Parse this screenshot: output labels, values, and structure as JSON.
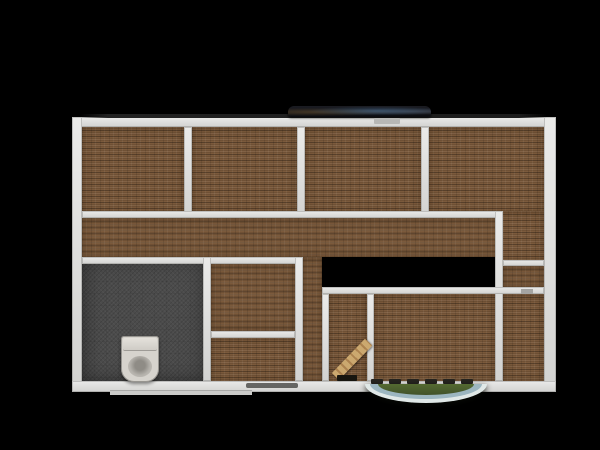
{
  "scene": {
    "description": "top-down 3d render of a house floor plan on black background",
    "canvas": {
      "width": 600,
      "height": 450
    },
    "background_color": "#000000"
  },
  "palette": {
    "floor_wood": "#7b5a3c",
    "floor_wood_seam": "#64482c",
    "wall": "#dfdfdd",
    "wall_edge": "#737370",
    "bathroom_floor": "#4b4b4b",
    "toilet": "#d6d3cd",
    "stair_wood": "#c8a26c",
    "porch_green": "#4a5d2e",
    "porch_blue": "#9cb6c0",
    "porch_white": "#e0e8e7",
    "balcony_dark": "#14151b"
  },
  "floorplan": {
    "outer_bounds": {
      "x": 72,
      "y": 117,
      "w": 484,
      "h": 275
    },
    "floors": [
      {
        "id": "room-top-left",
        "type": "wood",
        "x": 82,
        "y": 127,
        "w": 102,
        "h": 88
      },
      {
        "id": "room-top-mid-left",
        "type": "wood",
        "x": 192,
        "y": 127,
        "w": 105,
        "h": 88
      },
      {
        "id": "room-top-mid-right",
        "type": "wood",
        "x": 305,
        "y": 127,
        "w": 116,
        "h": 88
      },
      {
        "id": "room-top-right",
        "type": "wood",
        "x": 429,
        "y": 127,
        "w": 115,
        "h": 88
      },
      {
        "id": "room-top-right-ext",
        "type": "wood",
        "x": 499,
        "y": 211,
        "w": 45,
        "h": 52
      },
      {
        "id": "hallway",
        "type": "wood",
        "x": 82,
        "y": 218,
        "w": 417,
        "h": 39
      },
      {
        "id": "bathroom",
        "type": "tile",
        "x": 82,
        "y": 257,
        "w": 125,
        "h": 125
      },
      {
        "id": "storage-room-upper",
        "type": "wood",
        "x": 211,
        "y": 264,
        "w": 84,
        "h": 67
      },
      {
        "id": "storage-room-lower",
        "type": "wood",
        "x": 211,
        "y": 338,
        "w": 84,
        "h": 44
      },
      {
        "id": "hall-passage",
        "type": "wood",
        "x": 303,
        "y": 257,
        "w": 19,
        "h": 125
      },
      {
        "id": "stair-room",
        "type": "wood",
        "x": 329,
        "y": 294,
        "w": 38,
        "h": 88
      },
      {
        "id": "room-bottom-mid",
        "type": "wood",
        "x": 374,
        "y": 294,
        "w": 121,
        "h": 88
      },
      {
        "id": "room-right-strip",
        "type": "wood",
        "x": 503,
        "y": 266,
        "w": 41,
        "h": 21
      },
      {
        "id": "room-bottom-right",
        "type": "wood",
        "x": 503,
        "y": 294,
        "w": 41,
        "h": 88
      }
    ],
    "walls": [
      {
        "id": "wall-outer-top",
        "x": 72,
        "y": 117,
        "w": 484,
        "h": 10
      },
      {
        "id": "wall-outer-left",
        "x": 72,
        "y": 117,
        "w": 10,
        "h": 275
      },
      {
        "id": "wall-outer-right",
        "x": 544,
        "y": 117,
        "w": 12,
        "h": 275
      },
      {
        "id": "wall-outer-bottom",
        "x": 72,
        "y": 381,
        "w": 484,
        "h": 11
      },
      {
        "id": "wall-top-rooms-1-2",
        "x": 184,
        "y": 127,
        "w": 8,
        "h": 91
      },
      {
        "id": "wall-top-rooms-2-3",
        "x": 297,
        "y": 127,
        "w": 8,
        "h": 91
      },
      {
        "id": "wall-top-rooms-3-4",
        "x": 421,
        "y": 127,
        "w": 8,
        "h": 91
      },
      {
        "id": "wall-hallway-top",
        "x": 82,
        "y": 211,
        "w": 417,
        "h": 7
      },
      {
        "id": "wall-right-vertical",
        "x": 495,
        "y": 211,
        "w": 8,
        "h": 170
      },
      {
        "id": "wall-hallway-bottom",
        "x": 82,
        "y": 257,
        "w": 221,
        "h": 7
      },
      {
        "id": "wall-right-upper",
        "x": 503,
        "y": 260,
        "w": 41,
        "h": 6
      },
      {
        "id": "wall-mid-horizontal",
        "x": 322,
        "y": 287,
        "w": 222,
        "h": 7
      },
      {
        "id": "wall-bathroom-right",
        "x": 203,
        "y": 257,
        "w": 8,
        "h": 124
      },
      {
        "id": "wall-storage-right",
        "x": 295,
        "y": 257,
        "w": 8,
        "h": 124
      },
      {
        "id": "wall-storage-divider",
        "x": 211,
        "y": 331,
        "w": 84,
        "h": 7
      },
      {
        "id": "wall-stair-room-left",
        "x": 322,
        "y": 294,
        "w": 7,
        "h": 87
      },
      {
        "id": "wall-stair-room-right",
        "x": 367,
        "y": 294,
        "w": 7,
        "h": 87
      }
    ],
    "objects": [
      {
        "id": "exterior-top-shade",
        "type": "topshade",
        "x": 80,
        "y": 114,
        "w": 467,
        "h": 4,
        "interactable": false
      },
      {
        "id": "balcony-terrace",
        "type": "balcony",
        "x": 288,
        "y": 106,
        "w": 143,
        "h": 11,
        "interactable": true
      },
      {
        "id": "balcony-door-mark",
        "type": "doormark",
        "x": 374,
        "y": 118,
        "w": 26,
        "h": 6,
        "interactable": false
      },
      {
        "id": "bottom-window-sill",
        "type": "sill",
        "x": 110,
        "y": 390,
        "w": 142,
        "h": 5,
        "interactable": false
      },
      {
        "id": "toilet",
        "type": "toilet",
        "x": 121,
        "y": 336,
        "w": 38,
        "h": 46,
        "interactable": true
      },
      {
        "id": "stair-flight",
        "type": "stair",
        "x": 339,
        "y": 370,
        "w": 48,
        "h": 10,
        "interactable": true
      },
      {
        "id": "stair-threshold",
        "type": "threshold",
        "x": 337,
        "y": 375,
        "w": 20,
        "h": 6,
        "interactable": false
      },
      {
        "id": "entry-door-dash-1",
        "type": "dash",
        "x": 371,
        "y": 379,
        "w": 12,
        "h": 5,
        "interactable": false
      },
      {
        "id": "entry-door-dash-2",
        "type": "dash",
        "x": 389,
        "y": 379,
        "w": 12,
        "h": 5,
        "interactable": false
      },
      {
        "id": "entry-door-dash-3",
        "type": "dash",
        "x": 407,
        "y": 379,
        "w": 12,
        "h": 5,
        "interactable": false
      },
      {
        "id": "entry-door-dash-4",
        "type": "dash",
        "x": 425,
        "y": 379,
        "w": 12,
        "h": 5,
        "interactable": false
      },
      {
        "id": "entry-door-dash-5",
        "type": "dash",
        "x": 443,
        "y": 379,
        "w": 12,
        "h": 5,
        "interactable": false
      },
      {
        "id": "entry-door-dash-6",
        "type": "dash",
        "x": 461,
        "y": 379,
        "w": 12,
        "h": 5,
        "interactable": false
      },
      {
        "id": "bottom-wall-smudge",
        "type": "smudge",
        "x": 246,
        "y": 383,
        "w": 52,
        "h": 5,
        "interactable": false
      },
      {
        "id": "right-door-seam",
        "type": "seam",
        "x": 521,
        "y": 289,
        "w": 12,
        "h": 5,
        "interactable": false
      },
      {
        "id": "entry-porch",
        "type": "porch",
        "x": 365,
        "y": 384,
        "w": 122,
        "h": 19,
        "interactable": true
      }
    ]
  }
}
